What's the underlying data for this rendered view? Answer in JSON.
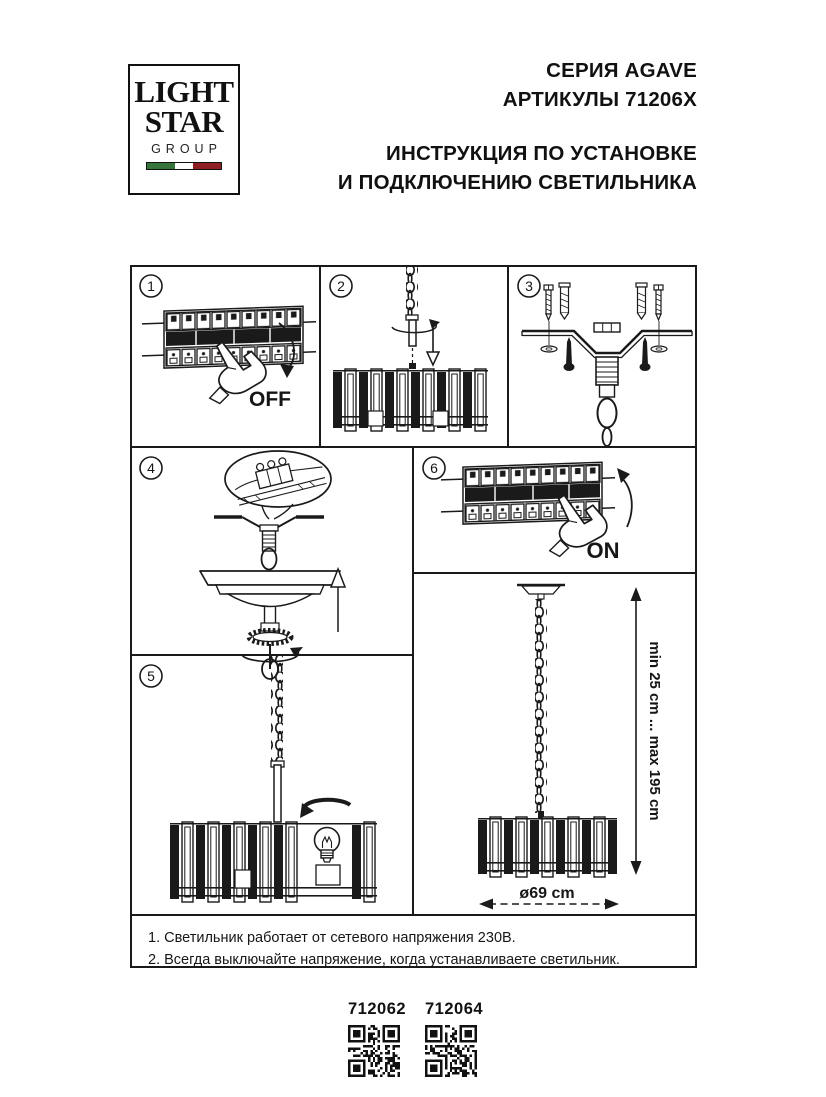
{
  "logo": {
    "line1": "LIGHT",
    "line2": "STAR",
    "line3": "GROUP"
  },
  "colors": {
    "ink": "#1a1a1a",
    "flag_green": "#35753c",
    "flag_white": "#ffffff",
    "flag_red": "#8e1f24"
  },
  "header": {
    "series": "СЕРИЯ AGAVE",
    "articles": "АРТИКУЛЫ 71206X",
    "title_line1": "ИНСТРУКЦИЯ ПО УСТАНОВКЕ",
    "title_line2": "И ПОДКЛЮЧЕНИЮ СВЕТИЛЬНИКА"
  },
  "steps": [
    {
      "number": "1",
      "label": "OFF"
    },
    {
      "number": "2",
      "label": ""
    },
    {
      "number": "3",
      "label": ""
    },
    {
      "number": "4",
      "label": ""
    },
    {
      "number": "5",
      "label": ""
    },
    {
      "number": "6",
      "label": "ON"
    }
  ],
  "dimensions": {
    "height_range": "min 25 cm ... max 195 cm",
    "diameter": "ø69 cm"
  },
  "notes": [
    "1. Светильник работает от сетевого напряжения 230В.",
    "2. Всегда выключайте напряжение, когда устанавливаете светильник."
  ],
  "qr_codes": [
    {
      "label": "712062"
    },
    {
      "label": "712064"
    }
  ]
}
